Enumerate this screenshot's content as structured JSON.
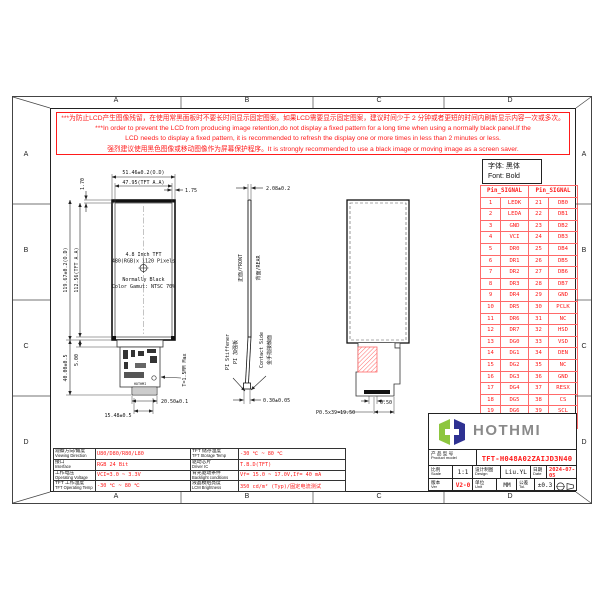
{
  "colors": {
    "red": "#ff1a1a",
    "logo_green": "#8dc63f",
    "logo_blue": "#2e3192",
    "logo_gray": "#8a8a8a"
  },
  "sheet": {
    "zones": [
      "A",
      "B",
      "C",
      "D"
    ]
  },
  "warning": {
    "line1": "***为防止LCD产生图像残留，在使用常黑面板时不要长时间显示固定图案。如果LCD需要显示固定图案，建议时间少于 2 分钟或者更短的时间内刷新显示内容一次或多次。",
    "line2": "***In order to prevent the LCD from producing image retention,do not display a fixed pattern for a long time when using a normally black panel.If the",
    "line3": "LCD needs to display a fixed pattern, it is recommended to refresh the display one or more times in less than 2 minutes or less.",
    "line4": "强烈建议使用黑色图像或移动图像作为屏幕保护程序。It is strongly recommended to use a black image or moving image as a screen saver."
  },
  "font_note": {
    "zh": "字体: 黑体",
    "en": "Font: Bold"
  },
  "pin_table": {
    "header": "Pin_SIGNAL",
    "rows": [
      [
        "1",
        "LEDK",
        "21",
        "DB0"
      ],
      [
        "2",
        "LEDA",
        "22",
        "DB1"
      ],
      [
        "3",
        "GND",
        "23",
        "DB2"
      ],
      [
        "4",
        "VCI",
        "24",
        "DB3"
      ],
      [
        "5",
        "DR0",
        "25",
        "DB4"
      ],
      [
        "6",
        "DR1",
        "26",
        "DB5"
      ],
      [
        "7",
        "DR2",
        "27",
        "DB6"
      ],
      [
        "8",
        "DR3",
        "28",
        "DB7"
      ],
      [
        "9",
        "DR4",
        "29",
        "GND"
      ],
      [
        "10",
        "DR5",
        "30",
        "PCLK"
      ],
      [
        "11",
        "DR6",
        "31",
        "NC"
      ],
      [
        "12",
        "DR7",
        "32",
        "HSD"
      ],
      [
        "13",
        "DG0",
        "33",
        "VSD"
      ],
      [
        "14",
        "DG1",
        "34",
        "DEN"
      ],
      [
        "15",
        "DG2",
        "35",
        "NC"
      ],
      [
        "16",
        "DG3",
        "36",
        "GND"
      ],
      [
        "17",
        "DG4",
        "37",
        "RESX"
      ],
      [
        "18",
        "DG5",
        "38",
        "CS"
      ],
      [
        "19",
        "DG6",
        "39",
        "SCL"
      ],
      [
        "20",
        "DG7",
        "40",
        "SDI"
      ]
    ]
  },
  "front_view": {
    "dim_width_od": "51.46±0.2(O.D)",
    "dim_width_aa": "47.95(TFT A.A)",
    "dim_offset_right": "1.75",
    "dim_offset_top": "1.70",
    "dim_height_od": "119.67±0.2(O.D)",
    "dim_height_aa": "112.56(TFT A.A)",
    "dim_fpc_length": "40.00±0.5",
    "dim_fpc_offset": "5.00",
    "thickness_note": "T=1.5MM Max",
    "dim_connector_w": "20.50±0.1",
    "dim_fingers_w": "15.48±0.5",
    "panel_line1": "4.8 Inch TFT",
    "panel_line2": "480(RGB)x 1120 Pixels",
    "panel_line3": "Normally Black",
    "panel_line4": "Color Gamut: NTSC 70%",
    "fpc_print": "HOTHMI"
  },
  "side_view": {
    "dim_thickness": "2.08±0.2",
    "front_label": "正面/FRONT",
    "rear_label": "背面/REAR",
    "stiffener_en": "PI Stiffener",
    "stiffener_zh": "PI 加强板",
    "contact_en": "Contact Side",
    "contact_zh": "金手指接触面",
    "dim_tip": "0.30±0.05"
  },
  "rear_view": {
    "dim_edge": "0.50",
    "dim_pitch": "P0.5x39=19.50"
  },
  "specs_left": {
    "rows": [
      {
        "zh": "观察方向/角度",
        "en": "Viewing Direction",
        "value": "U80/D80/R80/L80"
      },
      {
        "zh": "接口",
        "en": "Interface",
        "value": "RGB 24 Bit"
      },
      {
        "zh": "工作电压",
        "en": "Operating Voltage",
        "value": "VCI=3.0 ~ 3.3V"
      },
      {
        "zh": "TFT 工作温度",
        "en": "TFT Operating Temp",
        "value": "-30 ℃ ~ 80 ℃"
      }
    ]
  },
  "specs_right": {
    "rows": [
      {
        "zh": "TFT 储存温度",
        "en": "TFT Storage Temp",
        "value": "-30 ℃ ~ 80 ℃"
      },
      {
        "zh": "驱动芯片",
        "en": "Driver IC",
        "value": "T.B.D(TFT)"
      },
      {
        "zh": "背光驱动条件",
        "en": "Backlight conditions",
        "value": "Vf= 15.0 ~ 17.0V,If= 40 mA"
      },
      {
        "zh": "液晶模组亮度",
        "en": "LCM Brightness",
        "value": "350 cd/m² (Typ)/固定电流测试"
      }
    ]
  },
  "logo": {
    "name": "HOTHMI"
  },
  "title_block": {
    "product_zh": "产 品 型 号",
    "product_en": "Product model",
    "product_value": "TFT-H048A02ZAIJD3N40",
    "scale_zh": "比例",
    "scale_en": "Scale",
    "scale_value": "1:1",
    "design_zh": "设计制图",
    "design_en": "Design",
    "design_value": "Liu.YL",
    "date_zh": "日期",
    "date_en": "Date",
    "date_value": "2024-07-05",
    "ver_zh": "版本",
    "ver_en": "Ver",
    "ver_value": "V2-0",
    "unit_zh": "单位",
    "unit_en": "Unit",
    "unit_value": "MM",
    "tol_zh": "公差",
    "tol_en": "Tol.",
    "tol_value": "±0.3"
  }
}
